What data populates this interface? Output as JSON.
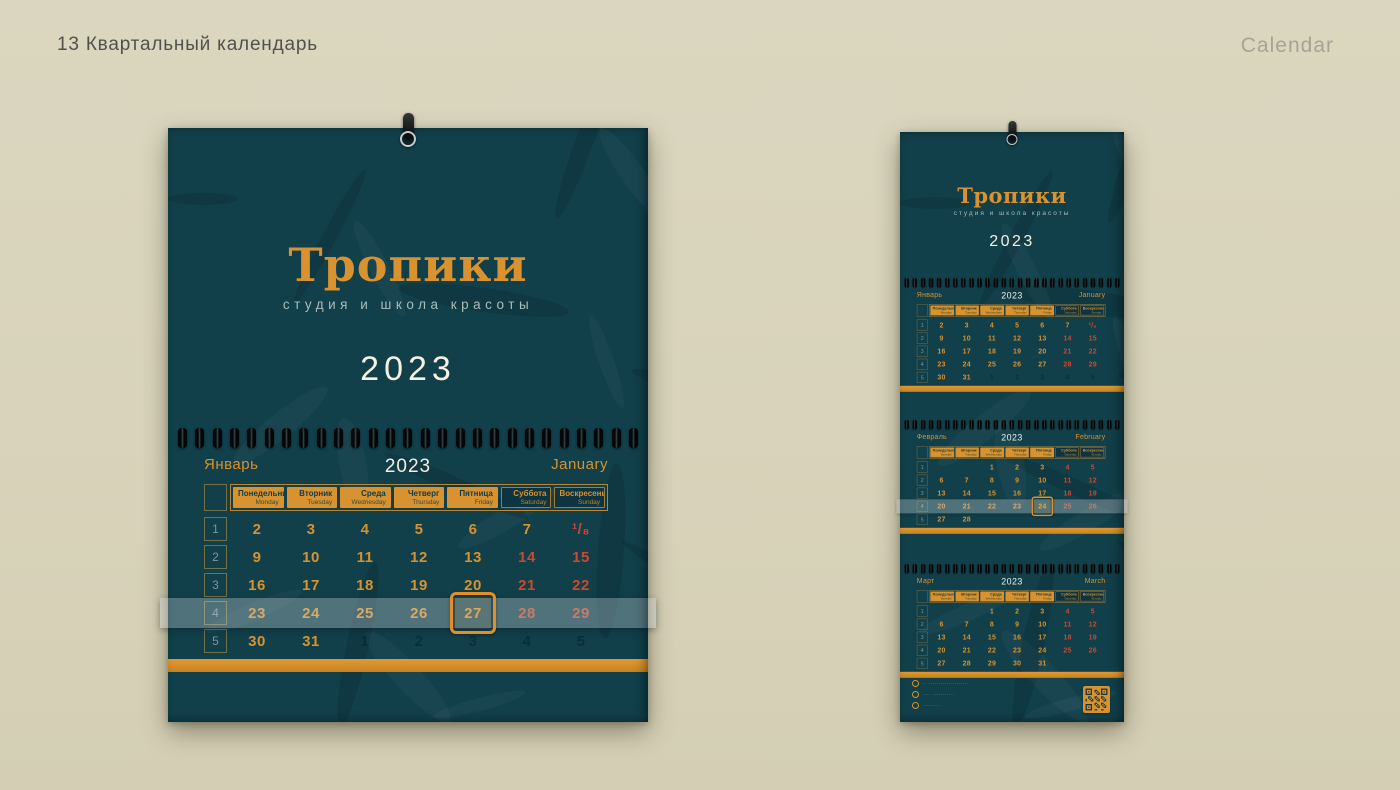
{
  "page": {
    "title": "13 Квартальный календарь",
    "corner_label": "Calendar"
  },
  "brand": {
    "name": "Тропики",
    "tagline": "студия и школа красоты",
    "year": "2023"
  },
  "colors": {
    "background_beige": "#d8d3ba",
    "calendar_teal": "#113f4a",
    "accent_orange": "#d8922f",
    "weekend_red": "#c94a2e",
    "year_cream": "#f6f1e2",
    "tagline_gray": "#a9bdb9"
  },
  "weekday_headers": [
    {
      "ru": "Понедельник",
      "en": "Monday",
      "weekend": false
    },
    {
      "ru": "Вторник",
      "en": "Tuesday",
      "weekend": false
    },
    {
      "ru": "Среда",
      "en": "Wednesday",
      "weekend": false
    },
    {
      "ru": "Четверг",
      "en": "Thursday",
      "weekend": false
    },
    {
      "ru": "Пятница",
      "en": "Friday",
      "weekend": false
    },
    {
      "ru": "Суббота",
      "en": "Saturday",
      "weekend": true
    },
    {
      "ru": "Воскресенье",
      "en": "Sunday",
      "weekend": true
    }
  ],
  "months": [
    {
      "id": "january",
      "ru": "Январь",
      "en": "January",
      "year": "2023",
      "weeks": [
        {
          "n": "1",
          "days": [
            {
              "t": "2"
            },
            {
              "t": "3"
            },
            {
              "t": "4"
            },
            {
              "t": "5"
            },
            {
              "t": "6"
            },
            {
              "t": "7"
            },
            {
              "t": "¹/₈",
              "we": true
            }
          ]
        },
        {
          "n": "2",
          "days": [
            {
              "t": "9"
            },
            {
              "t": "10"
            },
            {
              "t": "11"
            },
            {
              "t": "12"
            },
            {
              "t": "13"
            },
            {
              "t": "14",
              "we": true
            },
            {
              "t": "15",
              "we": true
            }
          ]
        },
        {
          "n": "3",
          "days": [
            {
              "t": "16"
            },
            {
              "t": "17"
            },
            {
              "t": "18"
            },
            {
              "t": "19"
            },
            {
              "t": "20"
            },
            {
              "t": "21",
              "we": true
            },
            {
              "t": "22",
              "we": true
            }
          ]
        },
        {
          "n": "4",
          "days": [
            {
              "t": "23"
            },
            {
              "t": "24"
            },
            {
              "t": "25"
            },
            {
              "t": "26"
            },
            {
              "t": "27"
            },
            {
              "t": "28",
              "we": true
            },
            {
              "t": "29",
              "we": true
            }
          ]
        },
        {
          "n": "5",
          "days": [
            {
              "t": "30"
            },
            {
              "t": "31"
            },
            {
              "t": "1",
              "faded": true
            },
            {
              "t": "2",
              "faded": true
            },
            {
              "t": "3",
              "faded": true
            },
            {
              "t": "4",
              "faded": true
            },
            {
              "t": "5",
              "faded": true
            }
          ]
        }
      ]
    },
    {
      "id": "february",
      "ru": "Февраль",
      "en": "February",
      "year": "2023",
      "weeks": [
        {
          "n": "1",
          "days": [
            null,
            null,
            {
              "t": "1"
            },
            {
              "t": "2"
            },
            {
              "t": "3"
            },
            {
              "t": "4",
              "we": true
            },
            {
              "t": "5",
              "we": true
            }
          ]
        },
        {
          "n": "2",
          "days": [
            {
              "t": "6"
            },
            {
              "t": "7"
            },
            {
              "t": "8"
            },
            {
              "t": "9"
            },
            {
              "t": "10"
            },
            {
              "t": "11",
              "we": true
            },
            {
              "t": "12",
              "we": true
            }
          ]
        },
        {
          "n": "3",
          "days": [
            {
              "t": "13"
            },
            {
              "t": "14"
            },
            {
              "t": "15"
            },
            {
              "t": "16"
            },
            {
              "t": "17"
            },
            {
              "t": "18",
              "we": true
            },
            {
              "t": "19",
              "we": true
            }
          ]
        },
        {
          "n": "4",
          "days": [
            {
              "t": "20"
            },
            {
              "t": "21"
            },
            {
              "t": "22"
            },
            {
              "t": "23"
            },
            {
              "t": "24"
            },
            {
              "t": "25",
              "we": true
            },
            {
              "t": "26",
              "we": true
            }
          ]
        },
        {
          "n": "5",
          "days": [
            {
              "t": "27"
            },
            {
              "t": "28"
            },
            null,
            null,
            null,
            null,
            null
          ]
        }
      ]
    },
    {
      "id": "march",
      "ru": "Март",
      "en": "March",
      "year": "2023",
      "weeks": [
        {
          "n": "1",
          "days": [
            null,
            null,
            {
              "t": "1"
            },
            {
              "t": "2"
            },
            {
              "t": "3"
            },
            {
              "t": "4",
              "we": true
            },
            {
              "t": "5",
              "we": true
            }
          ]
        },
        {
          "n": "2",
          "days": [
            {
              "t": "6"
            },
            {
              "t": "7"
            },
            {
              "t": "8"
            },
            {
              "t": "9"
            },
            {
              "t": "10"
            },
            {
              "t": "11",
              "we": true
            },
            {
              "t": "12",
              "we": true
            }
          ]
        },
        {
          "n": "3",
          "days": [
            {
              "t": "13"
            },
            {
              "t": "14"
            },
            {
              "t": "15"
            },
            {
              "t": "16"
            },
            {
              "t": "17"
            },
            {
              "t": "18",
              "we": true
            },
            {
              "t": "19",
              "we": true
            }
          ]
        },
        {
          "n": "4",
          "days": [
            {
              "t": "20"
            },
            {
              "t": "21"
            },
            {
              "t": "22"
            },
            {
              "t": "23"
            },
            {
              "t": "24"
            },
            {
              "t": "25",
              "we": true
            },
            {
              "t": "26",
              "we": true
            }
          ]
        },
        {
          "n": "5",
          "days": [
            {
              "t": "27"
            },
            {
              "t": "28"
            },
            {
              "t": "29"
            },
            {
              "t": "30"
            },
            {
              "t": "31"
            },
            null,
            null
          ]
        }
      ]
    }
  ],
  "sliders": {
    "large": {
      "month": "january",
      "week": 3,
      "day": 4,
      "framed_date": "27"
    },
    "strip": {
      "month": "february",
      "week": 3,
      "day": 4,
      "framed_date": "24"
    }
  },
  "contacts": {
    "lines": [
      {
        "text": "·· ····················"
      },
      {
        "text": "···· ···········"
      },
      {
        "text": "·········"
      }
    ]
  }
}
